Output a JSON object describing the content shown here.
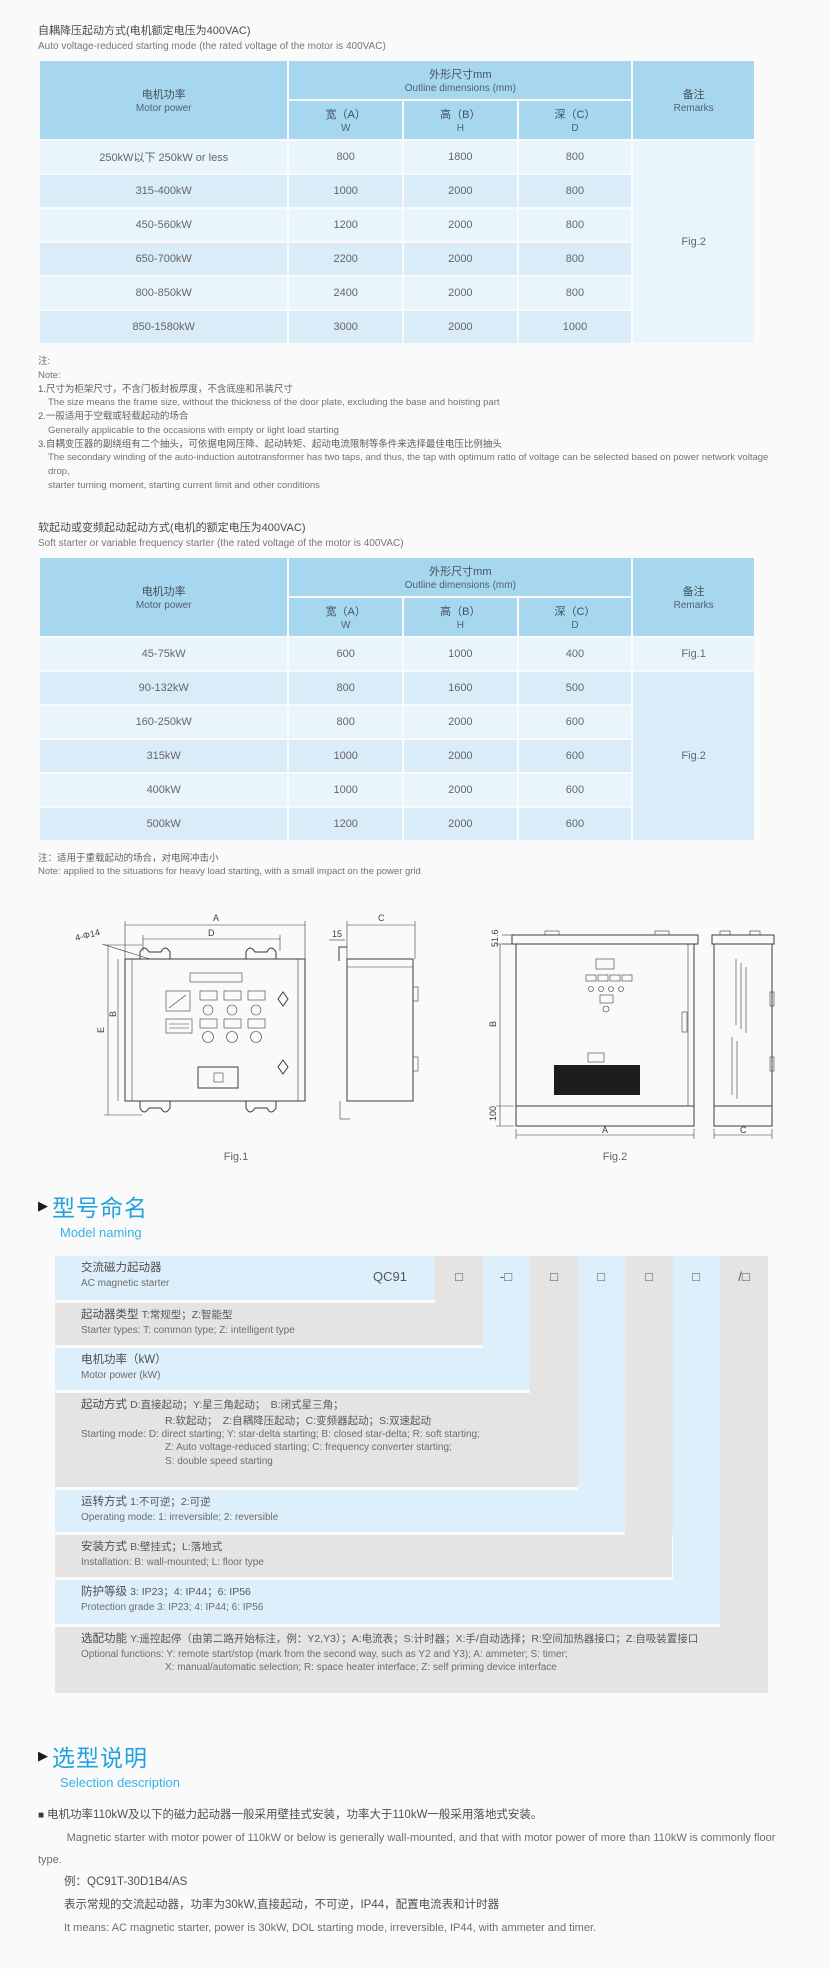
{
  "colors": {
    "accent_blue": "#22a3de",
    "table_header_bg": "#a6d7ef",
    "row_light": "#e9f5fc",
    "row_dark": "#d9ecf8",
    "panel_blue": "#ddeffa",
    "panel_gray": "#e5e4e2"
  },
  "table1": {
    "title_zh": "自耦降压起动方式(电机额定电压为400VAC)",
    "title_en": "Auto voltage-reduced starting mode (the rated voltage of the motor is 400VAC)",
    "header": {
      "motor_zh": "电机功率",
      "motor_en": "Motor power",
      "outline_zh": "外形尺寸mm",
      "outline_en": "Outline dimensions (mm)",
      "w_zh": "宽（A）",
      "w_en": "W",
      "h_zh": "高（B）",
      "h_en": "H",
      "d_zh": "深（C）",
      "d_en": "D",
      "remarks_zh": "备注",
      "remarks_en": "Remarks"
    },
    "rows": [
      {
        "power": "250kW以下 250kW or less",
        "w": "800",
        "h": "1800",
        "d": "800"
      },
      {
        "power": "315-400kW",
        "w": "1000",
        "h": "2000",
        "d": "800"
      },
      {
        "power": "450-560kW",
        "w": "1200",
        "h": "2000",
        "d": "800"
      },
      {
        "power": "650-700kW",
        "w": "2200",
        "h": "2000",
        "d": "800"
      },
      {
        "power": "800-850kW",
        "w": "2400",
        "h": "2000",
        "d": "800"
      },
      {
        "power": "850-1580kW",
        "w": "3000",
        "h": "2000",
        "d": "1000"
      }
    ],
    "remark": "Fig.2",
    "notes": {
      "zh_label": "注:",
      "en_label": "Note:",
      "n1_zh": "1.尺寸为柜架尺寸，不含门板封板厚度，不含底座和吊装尺寸",
      "n1_en": "The size means the frame size, without the thickness of the door plate, excluding the base and hoisting part",
      "n2_zh": "2.一般适用于空载或轻载起动的场合",
      "n2_en": "Generally applicable to the occasions with empty or light load starting",
      "n3_zh": "3.自耦变压器的副绕组有二个抽头，可依据电网压降、起动转矩、起动电流限制等条件来选择最佳电压比例抽头",
      "n3_en1": "The secondary winding of the auto-induction autotransformer has two taps, and thus, the tap with optimum ratio of voltage can be selected based on power network voltage drop,",
      "n3_en2": "starter turning moment, starting current limit and other conditions"
    }
  },
  "table2": {
    "title_zh": "软起动或变频起动起动方式(电机的额定电压为400VAC)",
    "title_en": "Soft starter or variable frequency starter (the rated voltage of the motor is 400VAC)",
    "rows": [
      {
        "power": "45-75kW",
        "w": "600",
        "h": "1000",
        "d": "400"
      },
      {
        "power": "90-132kW",
        "w": "800",
        "h": "1600",
        "d": "500"
      },
      {
        "power": "160-250kW",
        "w": "800",
        "h": "2000",
        "d": "600"
      },
      {
        "power": "315kW",
        "w": "1000",
        "h": "2000",
        "d": "600"
      },
      {
        "power": "400kW",
        "w": "1000",
        "h": "2000",
        "d": "600"
      },
      {
        "power": "500kW",
        "w": "1200",
        "h": "2000",
        "d": "600"
      }
    ],
    "remark1": "Fig.1",
    "remark2": "Fig.2",
    "note_zh": "注：适用于重载起动的场合，对电网冲击小",
    "note_en": "Note: applied to the situations for heavy load starting, with a small impact on the power grid"
  },
  "figures": {
    "fig1": {
      "caption": "Fig.1",
      "dim_a": "A",
      "dim_d": "D",
      "dim_holes": "4-Φ14",
      "dim_e": "E",
      "dim_b": "B",
      "dim_15": "15",
      "dim_c": "C"
    },
    "fig2": {
      "caption": "Fig.2",
      "dim_516": "51.6",
      "dim_b": "B",
      "dim_100": "100",
      "dim_a": "A",
      "dim_c": "C"
    }
  },
  "model_naming": {
    "heading_zh": "型号命名",
    "heading_en": "Model naming",
    "prefix": "QC91",
    "codes": [
      "□",
      "-□",
      "□",
      "□",
      "□",
      "□",
      "/□"
    ],
    "rows": {
      "r1_zh": "交流磁力起动器",
      "r1_en": "AC magnetic starter",
      "r2_t": "起动器类型",
      "r2_d": "T:常规型；Z:智能型",
      "r2_en": "Starter types: T: common type; Z: intelligent type",
      "r3_zh": "电机功率（kW）",
      "r3_en": "Motor power (kW)",
      "r4_t": "起动方式",
      "r4_d1": "D:直接起动；Y:星三角起动；　B:闭式星三角；",
      "r4_d2": "R:软起动；　Z:自耦降压起动；C:变频器起动；S:双速起动",
      "r4_en1": "Starting mode: D: direct starting; Y: star-delta starting; B: closed star-delta; R: soft starting;",
      "r4_en2": "Z: Auto voltage-reduced starting; C: frequency converter starting;",
      "r4_en3": "S: double speed starting",
      "r5_t": "运转方式",
      "r5_d": "1:不可逆；2:可逆",
      "r5_en": "Operating mode: 1: irreversible; 2: reversible",
      "r6_t": "安装方式",
      "r6_d": "B:壁挂式；L:落地式",
      "r6_en": "Installation: B: wall-mounted; L: floor type",
      "r7_t": "防护等级",
      "r7_d": "3: IP23；4: IP44；6: IP56",
      "r7_en": "Protection grade  3: IP23; 4: IP44; 6: IP56",
      "r8_t": "选配功能",
      "r8_d": "Y:遥控起停（由第二路开始标注，例：Y2,Y3）；A:电流表；S:计时器；X:手/自动选择；R:空间加热器接口；Z:自吸装置接口",
      "r8_en1": "Optional functions: Y: remote start/stop (mark from the second way, such as Y2 and Y3); A: ammeter; S: timer;",
      "r8_en2": "X: manual/automatic selection; R: space heater interface; Z: self priming device interface"
    }
  },
  "selection": {
    "heading_zh": "选型说明",
    "heading_en": "Selection description",
    "bullet": "■",
    "p1_zh": "电机功率110kW及以下的磁力起动器一般采用壁挂式安装，功率大于110kW一般采用落地式安装。",
    "p1_en": "Magnetic starter with motor power of 110kW or below is generally wall-mounted, and that with motor power of more than 110kW is commonly floor type.",
    "example": "例：QC91T-30D1B4/AS",
    "ex_zh": "表示常规的交流起动器，功率为30kW,直接起动，不可逆，IP44，配置电流表和计时器",
    "ex_en": "It means: AC magnetic starter, power is 30kW, DOL starting mode, irreversible, IP44, with ammeter and timer."
  }
}
